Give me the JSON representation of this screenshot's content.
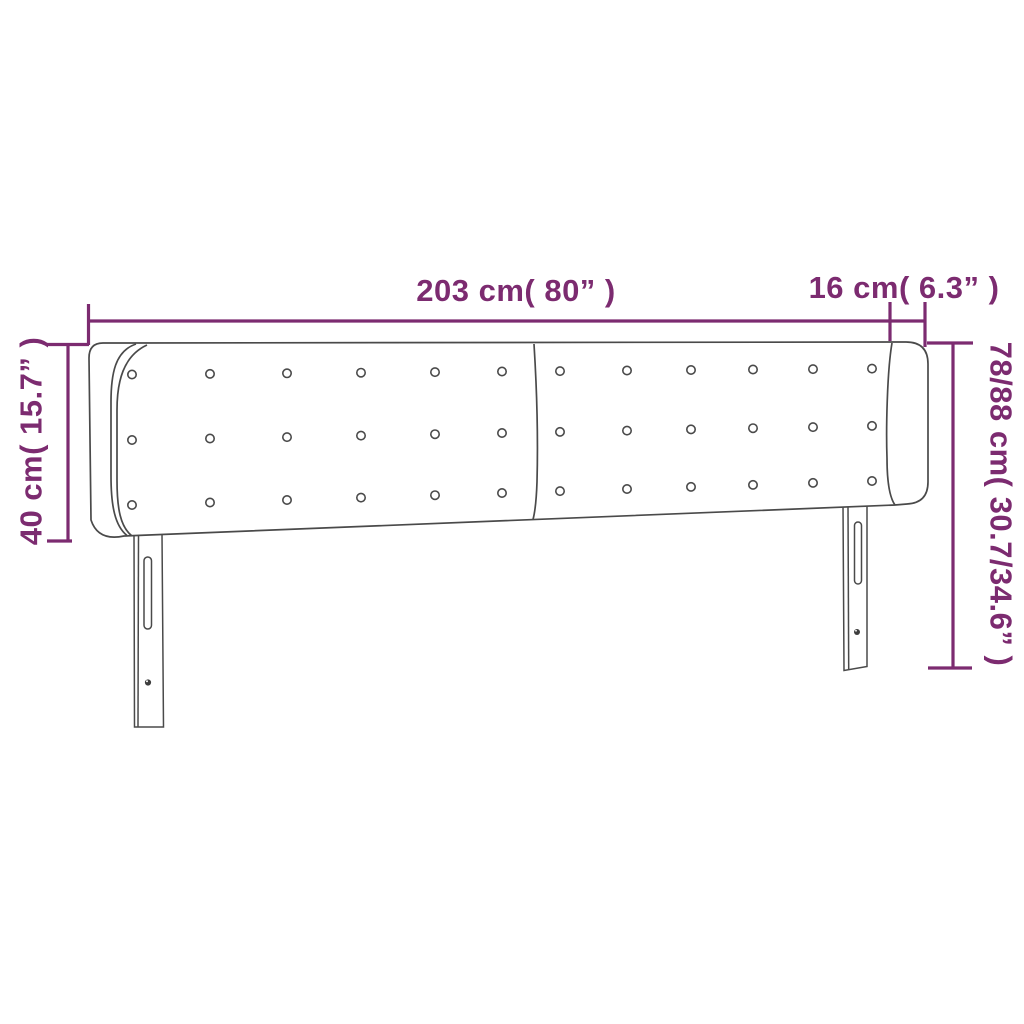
{
  "page": {
    "background": "#ffffff"
  },
  "diagram": {
    "kind": "headboard-dimension-drawing",
    "colors": {
      "dimension": "#7c2b70",
      "outline": "#4a4a4a"
    },
    "labels": {
      "total_width": "203 cm( 80” )",
      "ear_depth": "16 cm( 6.3” )",
      "headboard_height": "40 cm( 15.7” )",
      "overall_height": "78/88 cm( 30.7/34.6” )"
    },
    "buttons": {
      "rows": 3,
      "columns": 12
    }
  }
}
